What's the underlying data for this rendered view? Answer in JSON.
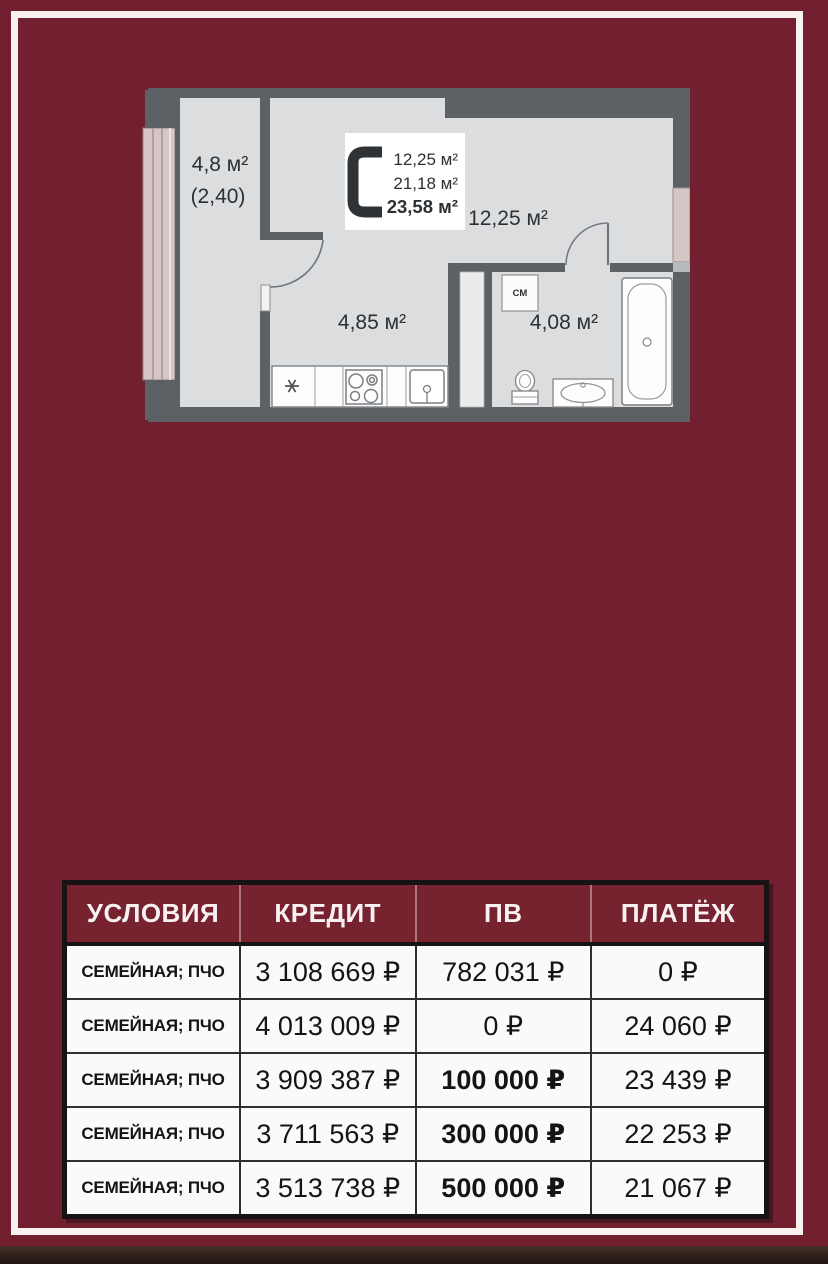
{
  "colors": {
    "background": "#72202f",
    "frame_line": "#f9f1f0",
    "table_header_bg": "#76222f",
    "wall_gray": "#5d6165",
    "floor_gray": "#dcddde",
    "window_pink": "#d7c6c6"
  },
  "floor_plan": {
    "unit_type": "С",
    "legend_areas": [
      "12,25 м²",
      "21,18 м²",
      "23,58 м²"
    ],
    "balcony_area": "4,8 м²",
    "balcony_area_reduced": "(2,40)",
    "main_room_area": "12,25 м²",
    "kitchen_area": "4,85 м²",
    "bathroom_area": "4,08 м²",
    "washing_machine_label": "СМ"
  },
  "offers_table": {
    "headers": [
      "УСЛОВИЯ",
      "КРЕДИТ",
      "ПВ",
      "ПЛАТЁЖ"
    ],
    "rows": [
      {
        "conditions": "СЕМЕЙНАЯ; ПЧО",
        "credit": "3 108 669 ₽",
        "down_payment": "782 031 ₽",
        "monthly_payment": "0 ₽",
        "down_payment_bold": false
      },
      {
        "conditions": "СЕМЕЙНАЯ; ПЧО",
        "credit": "4 013 009 ₽",
        "down_payment": "0 ₽",
        "monthly_payment": "24 060 ₽",
        "down_payment_bold": false
      },
      {
        "conditions": "СЕМЕЙНАЯ; ПЧО",
        "credit": "3 909 387 ₽",
        "down_payment": "100 000 ₽",
        "monthly_payment": "23 439 ₽",
        "down_payment_bold": true
      },
      {
        "conditions": "СЕМЕЙНАЯ; ПЧО",
        "credit": "3 711 563 ₽",
        "down_payment": "300 000 ₽",
        "monthly_payment": "22 253 ₽",
        "down_payment_bold": true
      },
      {
        "conditions": "СЕМЕЙНАЯ; ПЧО",
        "credit": "3 513 738 ₽",
        "down_payment": "500 000 ₽",
        "monthly_payment": "21 067 ₽",
        "down_payment_bold": true
      }
    ]
  }
}
